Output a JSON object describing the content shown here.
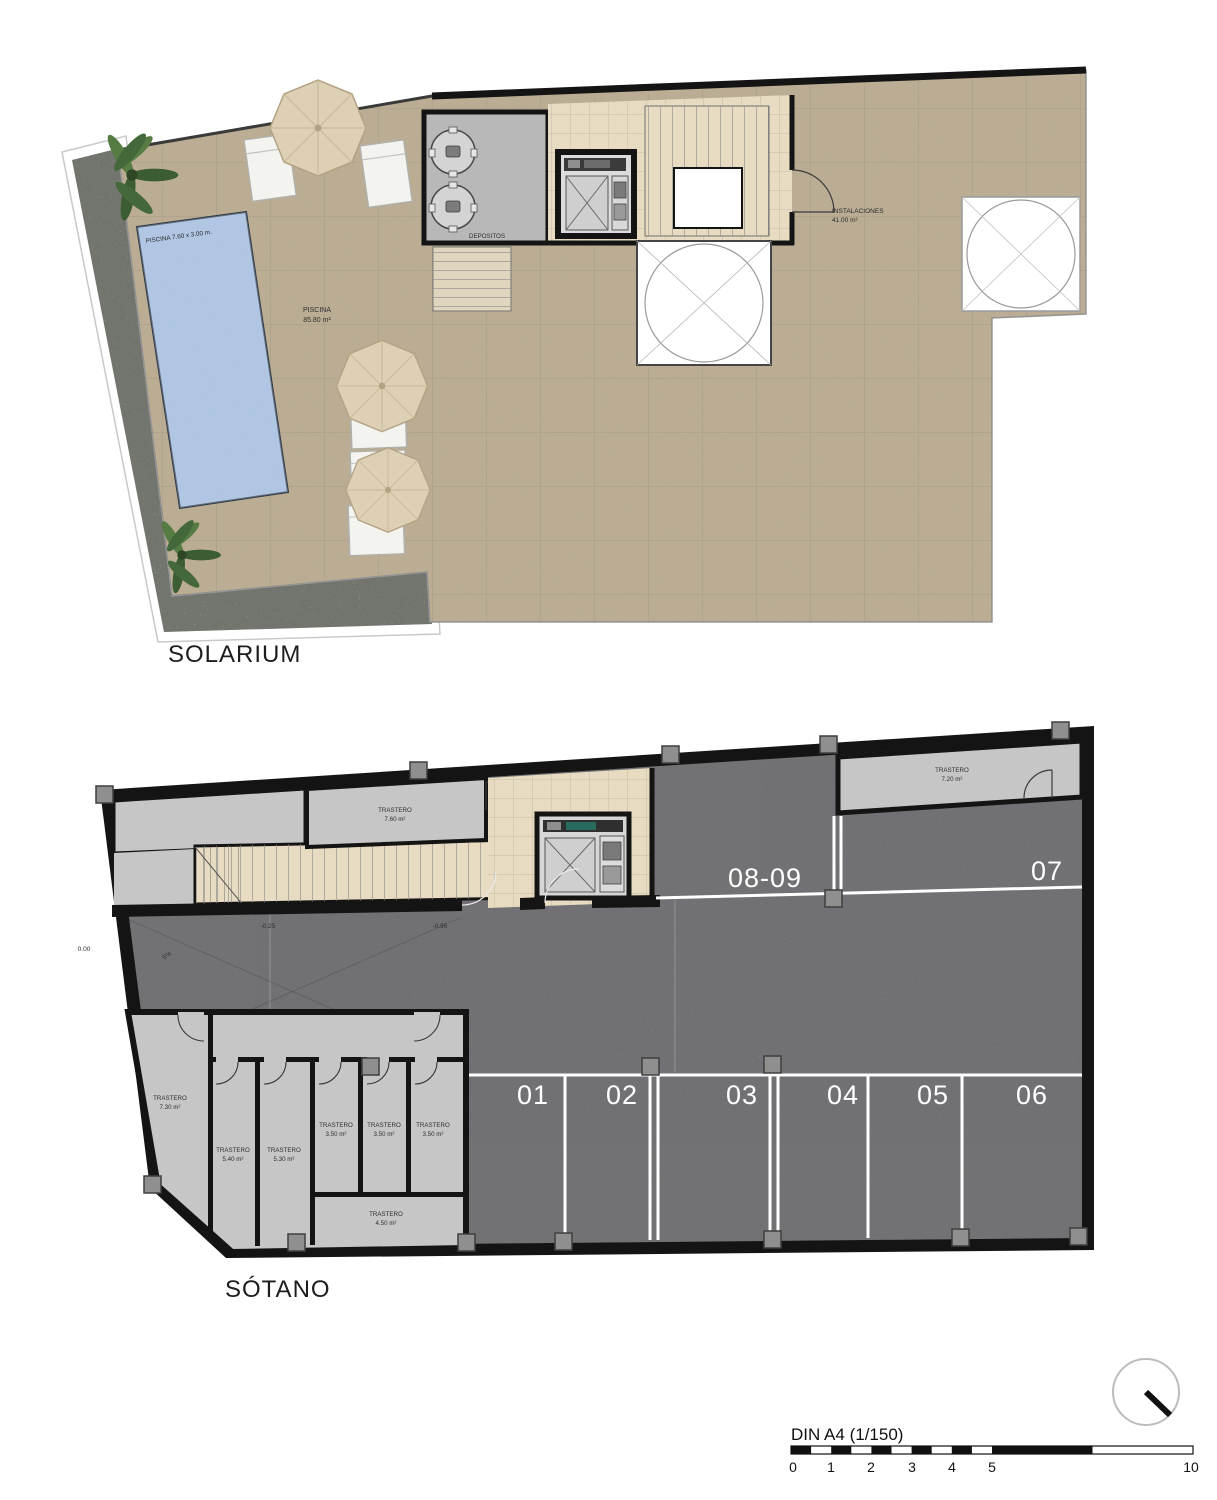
{
  "solarium": {
    "title": "SOLARIUM",
    "pool": {
      "dim_label": "PISCINA 7.60 x 3.00 m.",
      "name": "PISCINA",
      "area": "85.80 m²"
    },
    "depositos": {
      "name": "DEPOSITOS"
    },
    "instalaciones": {
      "name": "INSTALACIONES",
      "area": "41.00 m²"
    }
  },
  "sotano": {
    "title": "SÓTANO",
    "parking": {
      "top": [
        "08-09",
        "07"
      ],
      "bottom": [
        "01",
        "02",
        "03",
        "04",
        "05",
        "06"
      ]
    },
    "trasteros": {
      "t760": {
        "name": "TRASTERO",
        "area": "7.60 m²"
      },
      "t720": {
        "name": "TRASTERO",
        "area": "7.20 m²"
      },
      "t730": {
        "name": "TRASTERO",
        "area": "7.30 m²"
      },
      "t540": {
        "name": "TRASTERO",
        "area": "5.40 m²"
      },
      "t530": {
        "name": "TRASTERO",
        "area": "5.30 m²"
      },
      "t350a": {
        "name": "TRASTERO",
        "area": "3.50 m²"
      },
      "t350b": {
        "name": "TRASTERO",
        "area": "3.50 m²"
      },
      "t350c": {
        "name": "TRASTERO",
        "area": "3.50 m²"
      },
      "t450": {
        "name": "TRASTERO",
        "area": "4.50 m²"
      }
    },
    "levels": {
      "street": "0.00",
      "ramp_grade": "5%",
      "mid": "-0.25",
      "lobby": "-0.95"
    }
  },
  "scalebar": {
    "label": "DIN A4 (1/150)",
    "ticks": [
      "0",
      "1",
      "2",
      "3",
      "4",
      "5",
      "10"
    ]
  },
  "colors": {
    "terrace": "#c9bb9f",
    "pool": "#93b1d8",
    "asphalt": "#7e7e82",
    "storeroom": "#c6c6c6",
    "corridor": "#e7dcc1",
    "wall": "#141414",
    "parking_line": "#ffffff",
    "gravel": "#b9bcb2"
  }
}
